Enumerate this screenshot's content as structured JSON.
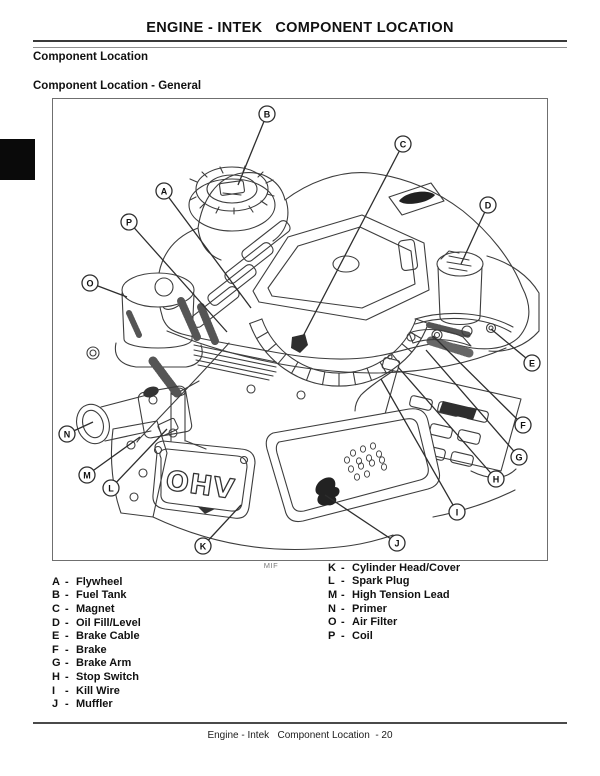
{
  "page": {
    "title": "ENGINE - INTEK   COMPONENT LOCATION",
    "section_heading": "Component Location",
    "subsection_heading": "Component Location - General",
    "figure_caption": "MIF",
    "footer_text": "Engine - Intek   Component Location  - 20"
  },
  "legend": {
    "left_column": [
      {
        "key": "A",
        "label": "Flywheel"
      },
      {
        "key": "B",
        "label": "Fuel Tank"
      },
      {
        "key": "C",
        "label": "Magnet"
      },
      {
        "key": "D",
        "label": "Oil Fill/Level"
      },
      {
        "key": "E",
        "label": "Brake Cable"
      },
      {
        "key": "F",
        "label": "Brake"
      },
      {
        "key": "G",
        "label": "Brake Arm"
      },
      {
        "key": "H",
        "label": "Stop Switch"
      },
      {
        "key": "I",
        "label": "Kill Wire"
      },
      {
        "key": "J",
        "label": "Muffler"
      }
    ],
    "right_column": [
      {
        "key": "K",
        "label": "Cylinder Head/Cover"
      },
      {
        "key": "L",
        "label": "Spark Plug"
      },
      {
        "key": "M",
        "label": "High Tension Lead"
      },
      {
        "key": "N",
        "label": "Primer"
      },
      {
        "key": "O",
        "label": "Air Filter"
      },
      {
        "key": "P",
        "label": "Coil"
      }
    ]
  },
  "diagram": {
    "engine_label": "OHV",
    "callouts": [
      {
        "letter": "A",
        "cx": 163,
        "cy": 190,
        "tx": 250,
        "ty": 307
      },
      {
        "letter": "B",
        "cx": 266,
        "cy": 113,
        "tx": 237,
        "ty": 184
      },
      {
        "letter": "C",
        "cx": 402,
        "cy": 143,
        "tx": 299,
        "ty": 341
      },
      {
        "letter": "D",
        "cx": 487,
        "cy": 204,
        "tx": 460,
        "ty": 263
      },
      {
        "letter": "E",
        "cx": 531,
        "cy": 362,
        "tx": 490,
        "ty": 328
      },
      {
        "letter": "F",
        "cx": 522,
        "cy": 424,
        "tx": 432,
        "ty": 335
      },
      {
        "letter": "G",
        "cx": 518,
        "cy": 456,
        "tx": 425,
        "ty": 349
      },
      {
        "letter": "H",
        "cx": 495,
        "cy": 478,
        "tx": 397,
        "ty": 366
      },
      {
        "letter": "I",
        "cx": 456,
        "cy": 511,
        "tx": 380,
        "ty": 378
      },
      {
        "letter": "J",
        "cx": 396,
        "cy": 542,
        "tx": 324,
        "ty": 494
      },
      {
        "letter": "K",
        "cx": 202,
        "cy": 545,
        "tx": 240,
        "ty": 504
      },
      {
        "letter": "L",
        "cx": 110,
        "cy": 487,
        "tx": 166,
        "ty": 428
      },
      {
        "letter": "M",
        "cx": 86,
        "cy": 474,
        "tx": 139,
        "ty": 436
      },
      {
        "letter": "N",
        "cx": 66,
        "cy": 433,
        "tx": 92,
        "ty": 421
      },
      {
        "letter": "O",
        "cx": 89,
        "cy": 282,
        "tx": 126,
        "ty": 296
      },
      {
        "letter": "P",
        "cx": 128,
        "cy": 221,
        "tx": 226,
        "ty": 331
      }
    ]
  },
  "colors": {
    "line_art": "#3d3d3d",
    "callout_stroke": "#2e2e2e",
    "text": "#111111",
    "caption_gray": "#7a7a7a",
    "tab_black": "#0a0a0a"
  }
}
